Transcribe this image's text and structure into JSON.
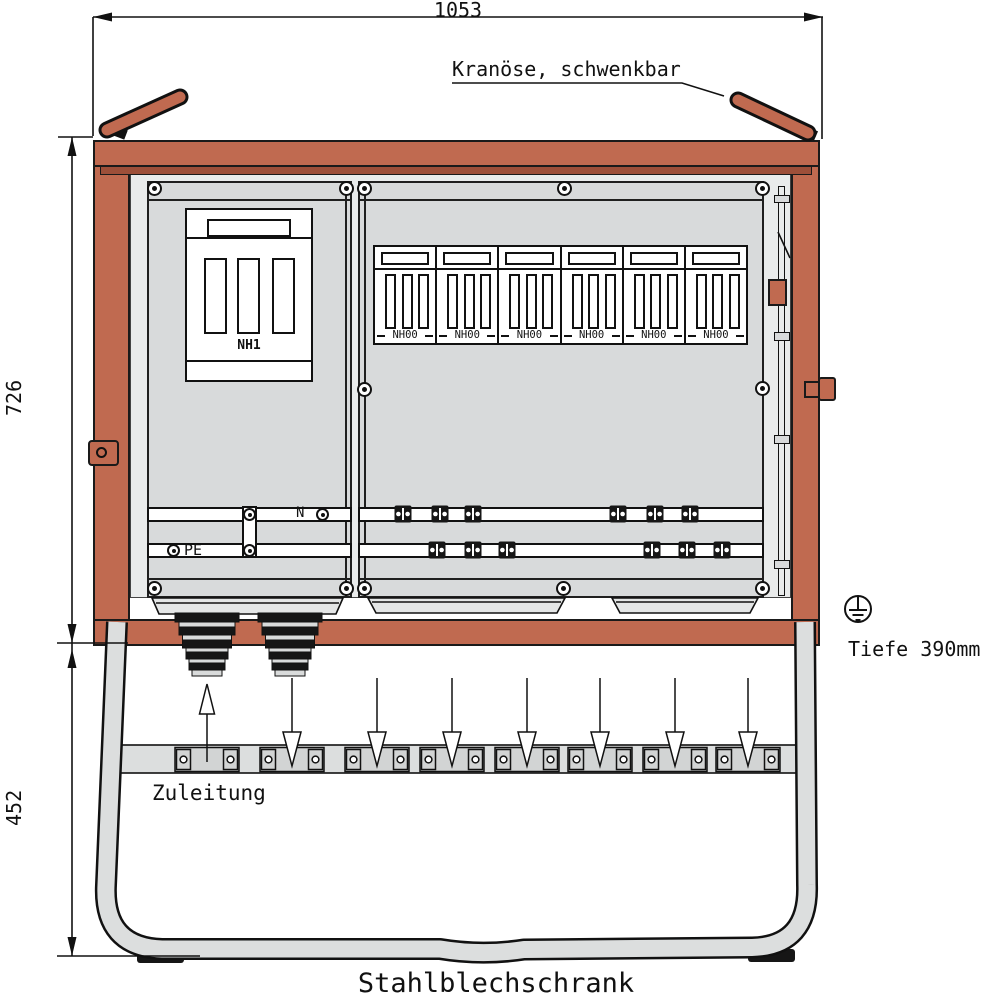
{
  "drawing": {
    "title": "Stahlblechschrank",
    "dim_width": "1053",
    "dim_height_upper": "726",
    "dim_height_lower": "452",
    "depth_note": "Tiefe 390mm",
    "crane_note": "Kranöse, schwenkbar",
    "supply_note": "Zuleitung"
  },
  "cabinet": {
    "main_fuse_label": "NH1",
    "neutral_label": "N",
    "earth_label": "PE",
    "nh00_units": [
      {
        "label": "NH00"
      },
      {
        "label": "NH00"
      },
      {
        "label": "NH00"
      },
      {
        "label": "NH00"
      },
      {
        "label": "NH00"
      },
      {
        "label": "NH00"
      }
    ],
    "flow": {
      "inlet_arrows_up": 1,
      "outlet_arrows_down": 7
    }
  },
  "colors": {
    "frame_red": "#c06a50",
    "frame_red_dark": "#9d4f39",
    "panel_gray": "#d8dadb",
    "interior_gray": "#e9ebeb",
    "metal_gray": "#dcdede",
    "line": "#1a1a1a"
  }
}
